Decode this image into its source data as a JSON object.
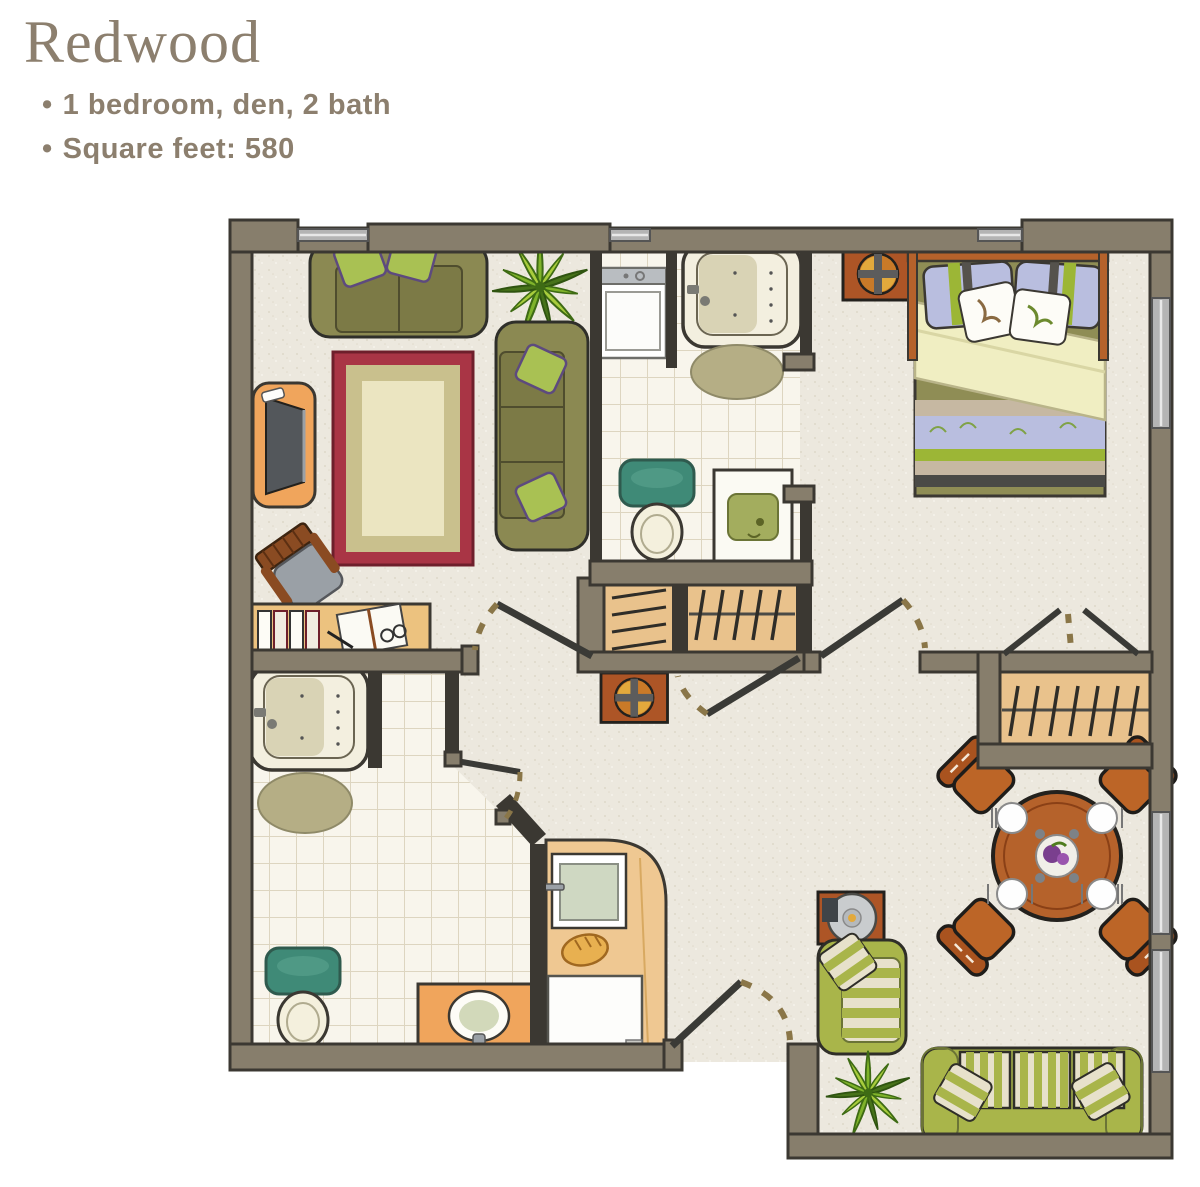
{
  "header": {
    "title": "Redwood",
    "bullet_char": "•",
    "bullets": [
      "1 bedroom, den, 2 bath",
      "Square feet: 580"
    ]
  },
  "palette": {
    "title_text": "#8c7f6e",
    "wall": "#877e6c",
    "wall_dark": "#3b3832",
    "floor": "#ece8de",
    "floor_speckle": "#ded8c9",
    "tile": "#f8f5ec",
    "tile_line": "#ddd5c0",
    "olive": "#8b8952",
    "olive_dark": "#7c7a46",
    "olive_line": "#4f4d2e",
    "pillow_green": "#a9c153",
    "pillow_purple": "#5d4a7e",
    "rug_red": "#a93545",
    "rug_tan": "#c9c08d",
    "rug_cream": "#ebe5c1",
    "wood": "#b5622b",
    "wood_dark": "#8a4016",
    "wood_light": "#ecc27f",
    "counter": "#efc892",
    "vanity_orange": "#f0a55c",
    "tv_gray": "#53575b",
    "plant_green": "#7fb32a",
    "plant_dark": "#47731a",
    "teal": "#3f8a77",
    "lavender": "#b9bedf",
    "bed_green": "#9cb636",
    "duvet_yellow": "#f0eec2",
    "bed_olive": "#8f8d55",
    "bed_tan": "#c6b8a2",
    "bed_dark": "#4a4a46",
    "sofa_green": "#a9b54a",
    "sofa_line": "#6b7436",
    "stripe_cream": "#e7e1cb",
    "rust": "#ad5526",
    "quad_yellow": "#e2a93c",
    "window_gray": "#b4b4b4",
    "steel_gray": "#9aa0a6",
    "mat_olive": "#b5ae85",
    "closet_wood": "#e9c28c",
    "dash_brown": "#8a7648",
    "door_dark": "#3a3a36"
  }
}
